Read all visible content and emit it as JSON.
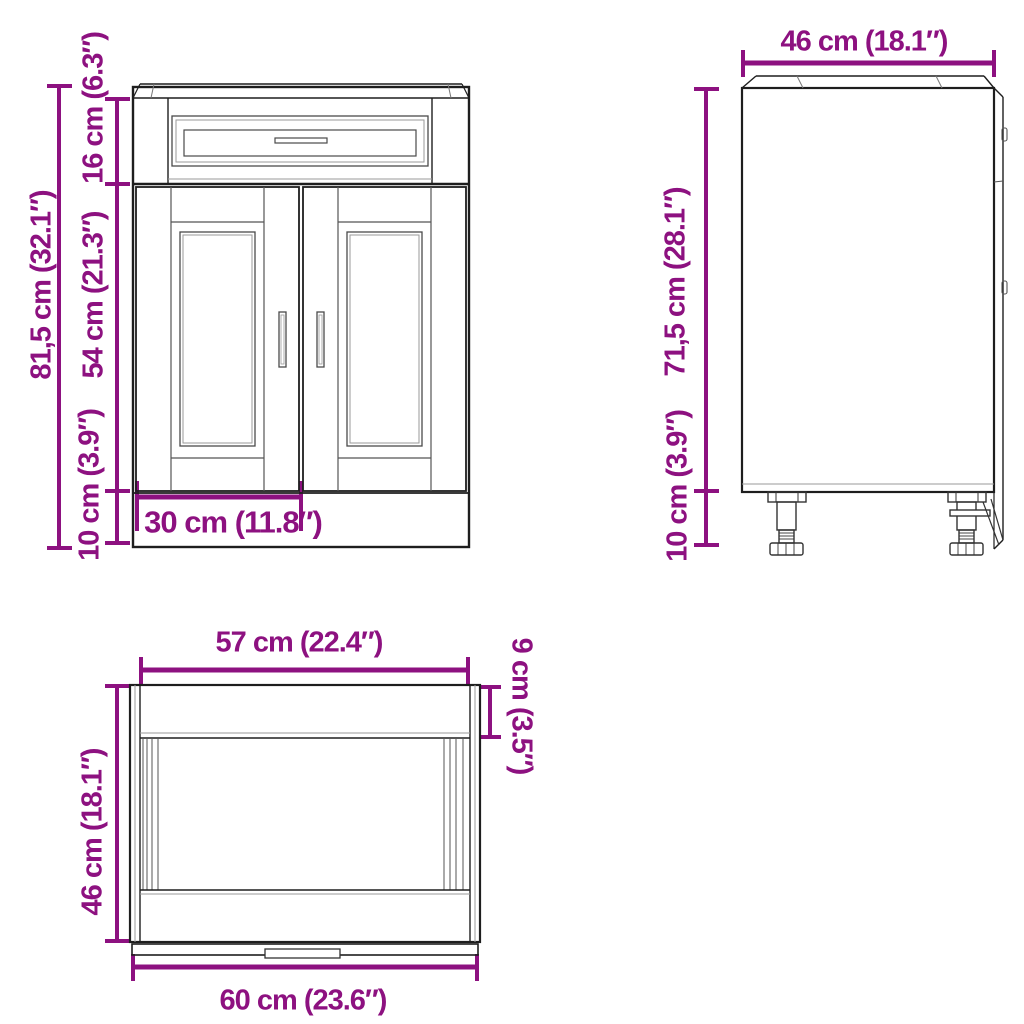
{
  "colors": {
    "dimension_accent": "#8D1180",
    "line_dark": "#1e1e1e"
  },
  "front_view": {
    "overall_height": "81,5 cm (32.1″)",
    "drawer_front_height": "16 cm (6.3″)",
    "doors_height": "54 cm (21.3″)",
    "plinth_height": "10 cm (3.9″)",
    "door_width": "30 cm (11.8″)"
  },
  "side_view": {
    "depth": "46 cm (18.1″)",
    "body_height": "71,5 cm (28.1″)",
    "feet_height": "10 cm (3.9″)"
  },
  "top_view": {
    "carcass_width": "57 cm (22.4″)",
    "rail_depth": "9 cm (3.5″)",
    "depth": "46 cm (18.1″)",
    "front_width": "60 cm (23.6″)"
  }
}
